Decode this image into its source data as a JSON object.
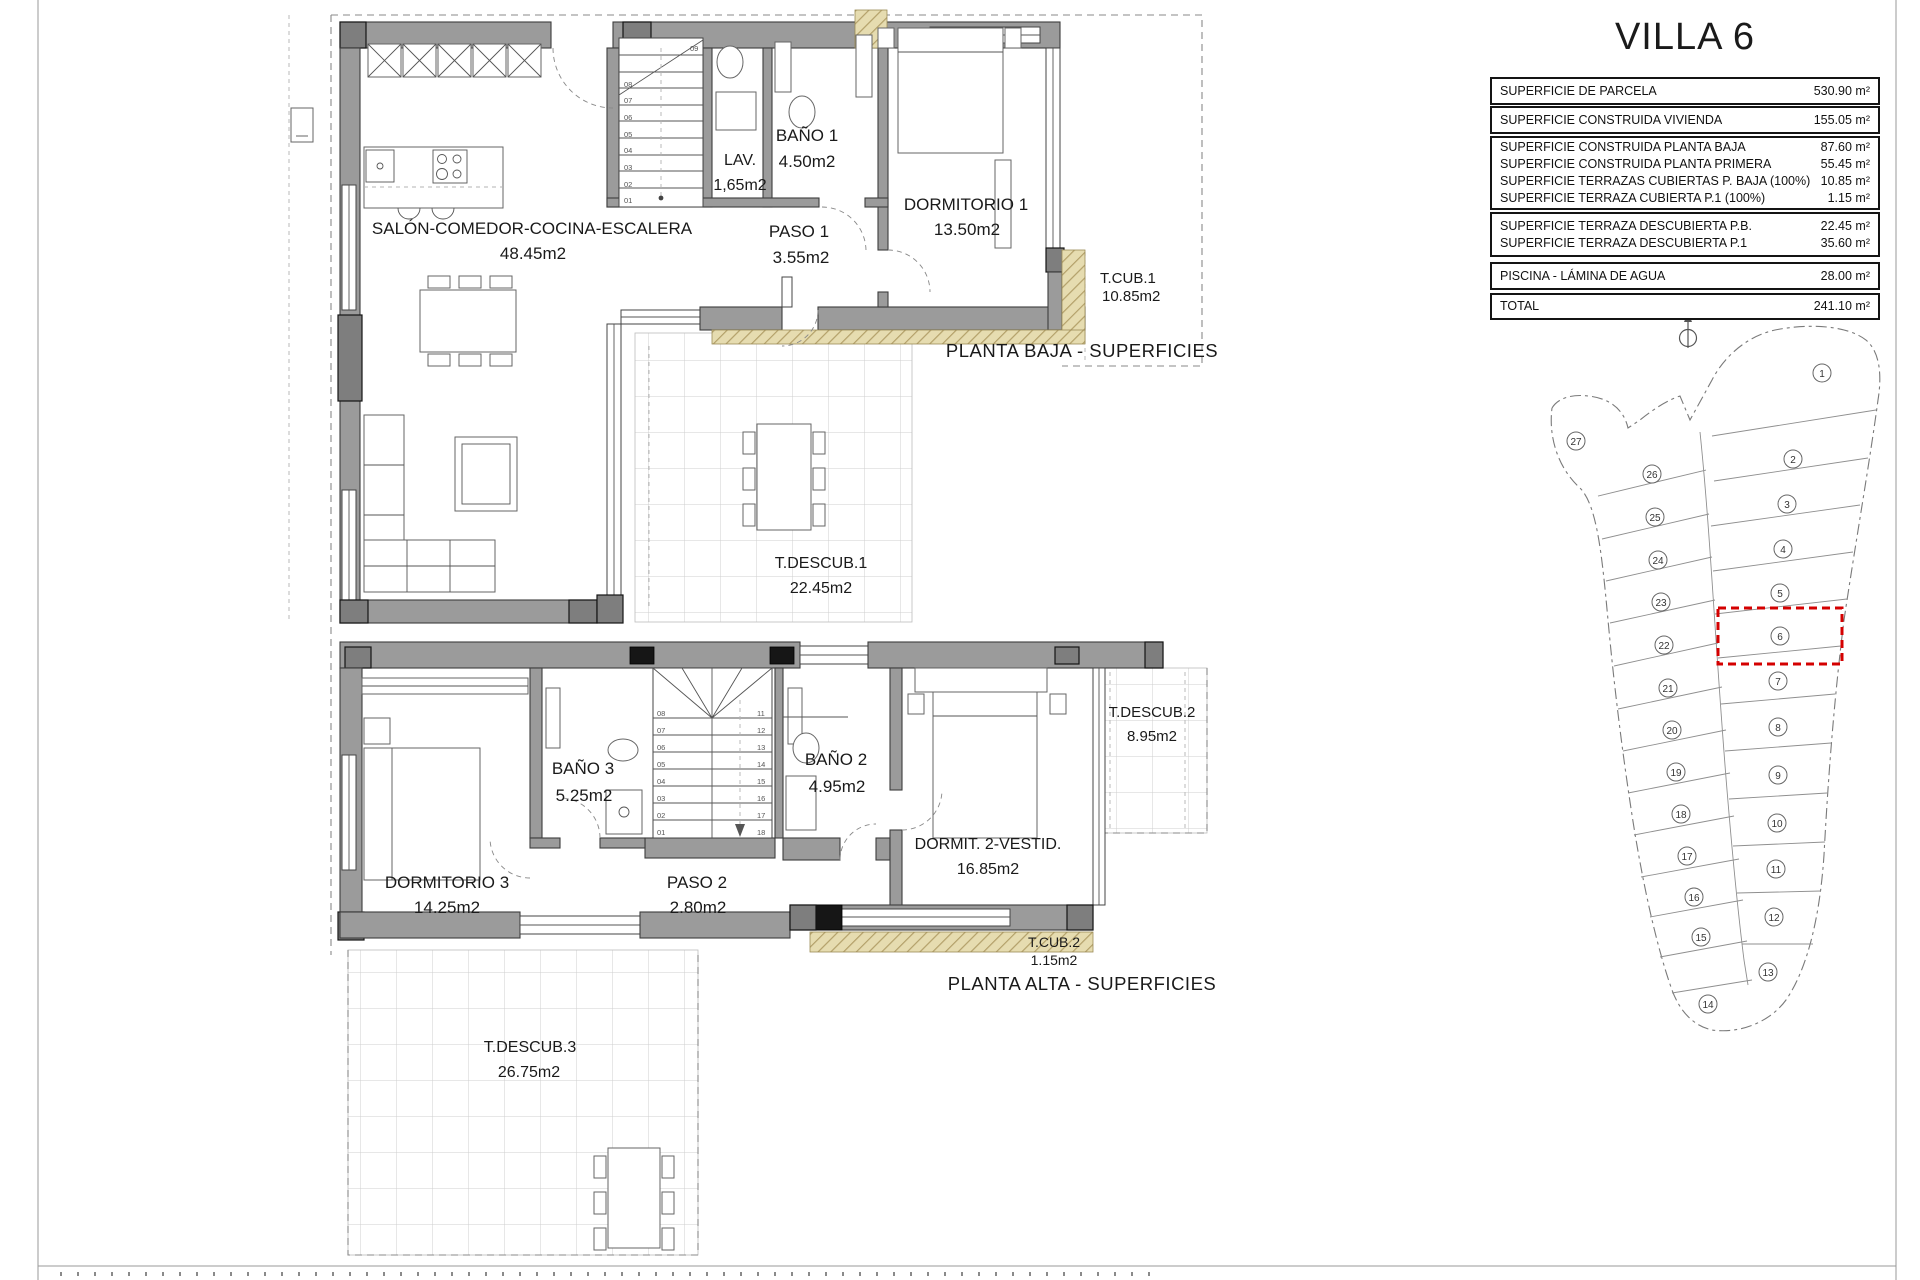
{
  "title": "VILLA 6",
  "surface_table": {
    "groups": [
      {
        "rows": [
          {
            "label": "SUPERFICIE DE PARCELA",
            "value": "530.90 m²"
          }
        ]
      },
      {
        "rows": [
          {
            "label": "SUPERFICIE CONSTRUIDA VIVIENDA",
            "value": "155.05 m²"
          }
        ]
      },
      {
        "rows": [
          {
            "label": "SUPERFICIE CONSTRUIDA PLANTA BAJA",
            "value": "87.60 m²"
          },
          {
            "label": "SUPERFICIE CONSTRUIDA PLANTA PRIMERA",
            "value": "55.45 m²"
          },
          {
            "label": "SUPERFICIE TERRAZAS CUBIERTAS P. BAJA (100%)",
            "value": "10.85 m²"
          },
          {
            "label": "SUPERFICIE TERRAZA CUBIERTA P.1 (100%)",
            "value": "1.15 m²"
          }
        ]
      },
      {
        "rows": [
          {
            "label": "SUPERFICIE TERRAZA DESCUBIERTA P.B.",
            "value": "22.45 m²"
          },
          {
            "label": "SUPERFICIE TERRAZA DESCUBIERTA P.1",
            "value": "35.60 m²"
          }
        ]
      },
      {
        "rows": [
          {
            "label": "PISCINA - LÁMINA DE AGUA",
            "value": "28.00 m²"
          }
        ]
      },
      {
        "rows": [
          {
            "label": "TOTAL",
            "value": "241.10 m²"
          }
        ]
      }
    ]
  },
  "planta_baja": {
    "caption": "PLANTA BAJA - SUPERFICIES",
    "rooms": {
      "salon": {
        "name": "SALÓN-COMEDOR-COCINA-ESCALERA",
        "area": "48.45m2"
      },
      "lav": {
        "name": "LAV.",
        "area": "1,65m2"
      },
      "bano1": {
        "name": "BAÑO 1",
        "area": "4.50m2"
      },
      "paso1": {
        "name": "PASO 1",
        "area": "3.55m2"
      },
      "dormitorio1": {
        "name": "DORMITORIO 1",
        "area": "13.50m2"
      },
      "tcub1": {
        "name": "T.CUB.1",
        "area": "10.85m2"
      },
      "tdescub1": {
        "name": "T.DESCUB.1",
        "area": "22.45m2"
      }
    },
    "stair_labels": [
      "01",
      "02",
      "03",
      "04",
      "05",
      "06",
      "07",
      "08",
      "09"
    ]
  },
  "planta_alta": {
    "caption": "PLANTA ALTA - SUPERFICIES",
    "rooms": {
      "dormitorio3": {
        "name": "DORMITORIO 3",
        "area": "14.25m2"
      },
      "bano3": {
        "name": "BAÑO 3",
        "area": "5.25m2"
      },
      "paso2": {
        "name": "PASO 2",
        "area": "2.80m2"
      },
      "bano2": {
        "name": "BAÑO 2",
        "area": "4.95m2"
      },
      "dormit2": {
        "name": "DORMIT. 2-VESTID.",
        "area": "16.85m2"
      },
      "tcub2": {
        "name": "T.CUB.2",
        "area": "1.15m2"
      },
      "tdescub2": {
        "name": "T.DESCUB.2",
        "area": "8.95m2"
      },
      "tdescub3": {
        "name": "T.DESCUB.3",
        "area": "26.75m2"
      }
    },
    "stair_labels_left": [
      "01",
      "02",
      "03",
      "04",
      "05",
      "06",
      "07",
      "08"
    ],
    "stair_labels_right": [
      "11",
      "12",
      "13",
      "14",
      "15",
      "16",
      "17",
      "18"
    ]
  },
  "site_plan": {
    "highlighted_parcel": "6",
    "highlight_color": "#d40000",
    "parcels": [
      "1",
      "2",
      "3",
      "4",
      "5",
      "6",
      "7",
      "8",
      "9",
      "10",
      "11",
      "12",
      "13",
      "14",
      "15",
      "16",
      "17",
      "18",
      "19",
      "20",
      "21",
      "22",
      "23",
      "24",
      "25",
      "26",
      "27"
    ]
  },
  "colors": {
    "wall_gray": "#9b9b9b",
    "covered_terrace_hatch": "#e6dcb0",
    "highlight_red": "#d40000"
  }
}
